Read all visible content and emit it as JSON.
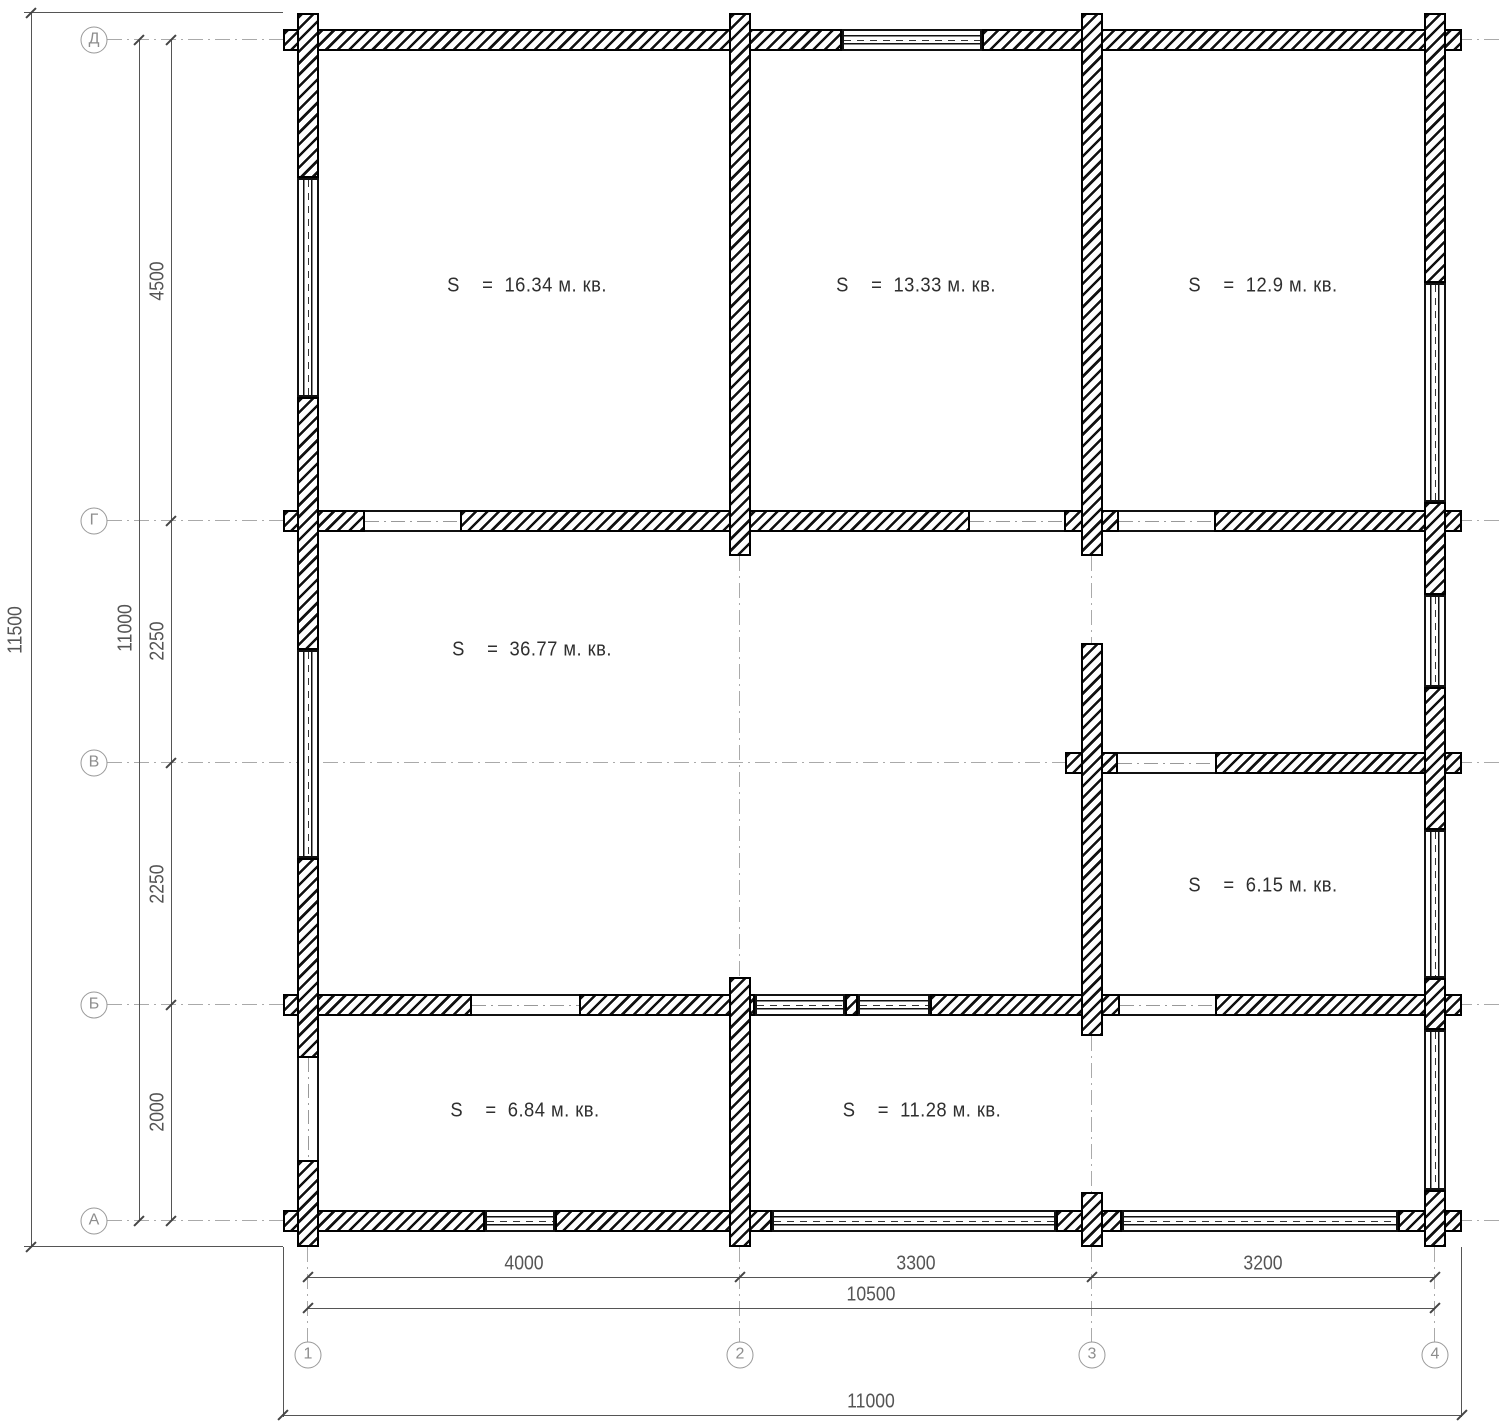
{
  "rooms": [
    {
      "text": "S    =  16.34 м. кв."
    },
    {
      "text": "S    =  13.33 м. кв."
    },
    {
      "text": "S    =  12.9 м. кв."
    },
    {
      "text": "S    =  36.77 м. кв."
    },
    {
      "text": "S    =  6.15 м. кв."
    },
    {
      "text": "S    =  6.84 м. кв."
    },
    {
      "text": "S    =  11.28 м. кв."
    }
  ],
  "axes": {
    "rows": [
      "Д",
      "Г",
      "В",
      "Б",
      "А"
    ],
    "cols": [
      "1",
      "2",
      "3",
      "4"
    ]
  },
  "dimensions": {
    "left_outer": "11500",
    "left_inner": "11000",
    "left_segments": [
      "4500",
      "2250",
      "2250",
      "2000"
    ],
    "bottom_segments": [
      "4000",
      "3300",
      "3200"
    ],
    "bottom_inner": "10500",
    "bottom_outer": "11000"
  }
}
